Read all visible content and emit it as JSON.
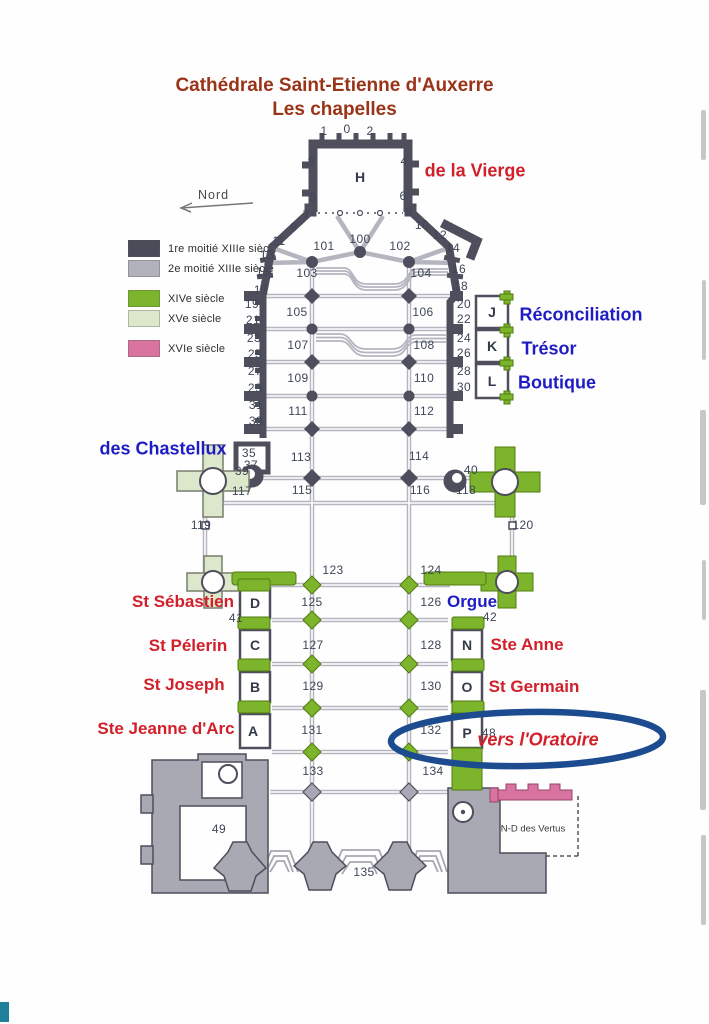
{
  "title": {
    "line1": "Cathédrale Saint-Etienne d'Auxerre",
    "line2": "Les chapelles"
  },
  "north_label": "Nord",
  "colors": {
    "title_red": "#9a3418",
    "chapel_red": "#d2202a",
    "chapel_blue": "#1f1cc4",
    "highlight_ellipse_blue": "#1c4c8f",
    "wall_dark": "#4e4e5c",
    "wall_light": "#b5b5c0",
    "green_14c": "#7cb52b",
    "palegreen_15c": "#dde7cb",
    "pink_16c": "#d9739f"
  },
  "legend": {
    "items": [
      {
        "label": "1re moitié XIIIe siècle",
        "color": "#4b4b59",
        "gap": false
      },
      {
        "label": "2e moitié XIIIe siècle",
        "color": "#b2b2bc",
        "gap": false
      },
      {
        "label": "XIVe siècle",
        "color": "#7cb52b",
        "gap": true
      },
      {
        "label": "XVe siècle",
        "color": "#dde7cb",
        "gap": false
      },
      {
        "label": "XVIe siècle",
        "color": "#d9739f",
        "gap": true
      }
    ]
  },
  "plan": {
    "highlight_label": "vers l'Oratoire",
    "labels": [
      {
        "t": "1",
        "x": 324,
        "y": 131,
        "k": "n"
      },
      {
        "t": "0",
        "x": 347,
        "y": 129,
        "k": "n"
      },
      {
        "t": "2",
        "x": 370,
        "y": 131,
        "k": "n"
      },
      {
        "t": "3",
        "x": 311,
        "y": 162,
        "k": "n"
      },
      {
        "t": "4",
        "x": 404,
        "y": 161,
        "k": "n"
      },
      {
        "t": "5",
        "x": 313,
        "y": 197,
        "k": "n"
      },
      {
        "t": "6",
        "x": 403,
        "y": 196,
        "k": "n"
      },
      {
        "t": "7",
        "x": 306,
        "y": 215,
        "k": "n"
      },
      {
        "t": "8",
        "x": 409,
        "y": 212,
        "k": "n"
      },
      {
        "t": "9",
        "x": 294,
        "y": 227,
        "k": "n"
      },
      {
        "t": "10",
        "x": 422,
        "y": 225,
        "k": "n"
      },
      {
        "t": "11",
        "x": 279,
        "y": 241,
        "k": "n"
      },
      {
        "t": "12",
        "x": 440,
        "y": 235,
        "k": "n"
      },
      {
        "t": "13",
        "x": 267,
        "y": 255,
        "k": "n"
      },
      {
        "t": "14",
        "x": 453,
        "y": 248,
        "k": "n"
      },
      {
        "t": "15",
        "x": 263,
        "y": 272,
        "k": "n"
      },
      {
        "t": "16",
        "x": 459,
        "y": 269,
        "k": "n"
      },
      {
        "t": "17",
        "x": 261,
        "y": 290,
        "k": "n"
      },
      {
        "t": "18",
        "x": 461,
        "y": 286,
        "k": "n"
      },
      {
        "t": "19",
        "x": 252,
        "y": 304,
        "k": "n"
      },
      {
        "t": "20",
        "x": 464,
        "y": 304,
        "k": "n"
      },
      {
        "t": "21",
        "x": 253,
        "y": 320,
        "k": "n"
      },
      {
        "t": "22",
        "x": 464,
        "y": 319,
        "k": "n"
      },
      {
        "t": "23",
        "x": 254,
        "y": 338,
        "k": "n"
      },
      {
        "t": "24",
        "x": 464,
        "y": 338,
        "k": "n"
      },
      {
        "t": "25",
        "x": 255,
        "y": 354,
        "k": "n"
      },
      {
        "t": "26",
        "x": 464,
        "y": 353,
        "k": "n"
      },
      {
        "t": "27",
        "x": 255,
        "y": 371,
        "k": "n"
      },
      {
        "t": "28",
        "x": 464,
        "y": 371,
        "k": "n"
      },
      {
        "t": "29",
        "x": 255,
        "y": 388,
        "k": "n"
      },
      {
        "t": "30",
        "x": 464,
        "y": 387,
        "k": "n"
      },
      {
        "t": "31",
        "x": 256,
        "y": 405,
        "k": "n"
      },
      {
        "t": "33",
        "x": 256,
        "y": 421,
        "k": "n"
      },
      {
        "t": "35",
        "x": 249,
        "y": 453,
        "k": "n"
      },
      {
        "t": "37",
        "x": 251,
        "y": 465,
        "k": "n"
      },
      {
        "t": "39",
        "x": 242,
        "y": 471,
        "k": "n"
      },
      {
        "t": "40",
        "x": 471,
        "y": 470,
        "k": "n"
      },
      {
        "t": "41",
        "x": 236,
        "y": 618,
        "k": "n"
      },
      {
        "t": "42",
        "x": 490,
        "y": 617,
        "k": "n"
      },
      {
        "t": "48",
        "x": 489,
        "y": 733,
        "k": "n"
      },
      {
        "t": "49",
        "x": 219,
        "y": 829,
        "k": "n"
      },
      {
        "t": "100",
        "x": 360,
        "y": 239,
        "k": "n"
      },
      {
        "t": "101",
        "x": 324,
        "y": 246,
        "k": "n"
      },
      {
        "t": "102",
        "x": 400,
        "y": 246,
        "k": "n"
      },
      {
        "t": "103",
        "x": 307,
        "y": 273,
        "k": "n"
      },
      {
        "t": "104",
        "x": 421,
        "y": 273,
        "k": "n"
      },
      {
        "t": "105",
        "x": 297,
        "y": 312,
        "k": "n"
      },
      {
        "t": "106",
        "x": 423,
        "y": 312,
        "k": "n"
      },
      {
        "t": "107",
        "x": 298,
        "y": 345,
        "k": "n"
      },
      {
        "t": "108",
        "x": 424,
        "y": 345,
        "k": "n"
      },
      {
        "t": "109",
        "x": 298,
        "y": 378,
        "k": "n"
      },
      {
        "t": "110",
        "x": 424,
        "y": 378,
        "k": "n"
      },
      {
        "t": "111",
        "x": 298,
        "y": 411,
        "k": "n"
      },
      {
        "t": "112",
        "x": 424,
        "y": 411,
        "k": "n"
      },
      {
        "t": "113",
        "x": 301,
        "y": 457,
        "k": "n"
      },
      {
        "t": "114",
        "x": 419,
        "y": 456,
        "k": "n"
      },
      {
        "t": "115",
        "x": 302,
        "y": 490,
        "k": "n"
      },
      {
        "t": "116",
        "x": 420,
        "y": 490,
        "k": "n"
      },
      {
        "t": "117",
        "x": 242,
        "y": 491,
        "k": "n"
      },
      {
        "t": "118",
        "x": 466,
        "y": 490,
        "k": "n"
      },
      {
        "t": "119",
        "x": 201,
        "y": 525,
        "k": "n"
      },
      {
        "t": "120",
        "x": 523,
        "y": 525,
        "k": "n"
      },
      {
        "t": "123",
        "x": 333,
        "y": 570,
        "k": "n"
      },
      {
        "t": "124",
        "x": 431,
        "y": 570,
        "k": "n"
      },
      {
        "t": "125",
        "x": 312,
        "y": 602,
        "k": "n"
      },
      {
        "t": "126",
        "x": 431,
        "y": 602,
        "k": "n"
      },
      {
        "t": "127",
        "x": 313,
        "y": 645,
        "k": "n"
      },
      {
        "t": "128",
        "x": 431,
        "y": 645,
        "k": "n"
      },
      {
        "t": "129",
        "x": 313,
        "y": 686,
        "k": "n"
      },
      {
        "t": "130",
        "x": 431,
        "y": 686,
        "k": "n"
      },
      {
        "t": "131",
        "x": 312,
        "y": 730,
        "k": "n"
      },
      {
        "t": "132",
        "x": 431,
        "y": 730,
        "k": "n"
      },
      {
        "t": "133",
        "x": 313,
        "y": 771,
        "k": "n"
      },
      {
        "t": "134",
        "x": 433,
        "y": 771,
        "k": "n"
      },
      {
        "t": "135",
        "x": 364,
        "y": 872,
        "k": "n"
      },
      {
        "t": "H",
        "x": 360,
        "y": 177,
        "k": "l",
        "n": "chapel-letter-H"
      },
      {
        "t": "J",
        "x": 492,
        "y": 312,
        "k": "l",
        "n": "chapel-letter-J"
      },
      {
        "t": "K",
        "x": 492,
        "y": 346,
        "k": "l",
        "n": "chapel-letter-K"
      },
      {
        "t": "L",
        "x": 492,
        "y": 381,
        "k": "l",
        "n": "chapel-letter-L"
      },
      {
        "t": "D",
        "x": 255,
        "y": 603,
        "k": "l",
        "n": "chapel-letter-D"
      },
      {
        "t": "C",
        "x": 255,
        "y": 645,
        "k": "l",
        "n": "chapel-letter-C"
      },
      {
        "t": "B",
        "x": 255,
        "y": 687,
        "k": "l",
        "n": "chapel-letter-B"
      },
      {
        "t": "A",
        "x": 253,
        "y": 731,
        "k": "l",
        "n": "chapel-letter-A"
      },
      {
        "t": "N",
        "x": 467,
        "y": 645,
        "k": "l",
        "n": "chapel-letter-N"
      },
      {
        "t": "O",
        "x": 467,
        "y": 687,
        "k": "l",
        "n": "chapel-letter-O"
      },
      {
        "t": "P",
        "x": 467,
        "y": 733,
        "k": "l",
        "n": "chapel-letter-P"
      },
      {
        "t": "de la Vierge",
        "x": 475,
        "y": 171,
        "k": "r",
        "s": 18,
        "n": "chapel-name-de-la-vierge"
      },
      {
        "t": "Réconciliation",
        "x": 581,
        "y": 315,
        "k": "b",
        "s": 18,
        "n": "chapel-name-reconciliation"
      },
      {
        "t": "Trésor",
        "x": 549,
        "y": 349,
        "k": "b",
        "s": 18,
        "n": "chapel-name-tresor"
      },
      {
        "t": "Boutique",
        "x": 557,
        "y": 383,
        "k": "b",
        "s": 18,
        "n": "chapel-name-boutique"
      },
      {
        "t": "des Chastellux",
        "x": 163,
        "y": 449,
        "k": "b",
        "s": 18,
        "n": "chapel-name-des-chastellux"
      },
      {
        "t": "St Sébastien",
        "x": 183,
        "y": 602,
        "k": "r",
        "n": "chapel-name-st-sebastien"
      },
      {
        "t": "Orgue",
        "x": 472,
        "y": 602,
        "k": "b",
        "n": "chapel-name-orgue"
      },
      {
        "t": "St Pélerin",
        "x": 188,
        "y": 646,
        "k": "r",
        "n": "chapel-name-st-pelerin"
      },
      {
        "t": "Ste Anne",
        "x": 527,
        "y": 645,
        "k": "r",
        "n": "chapel-name-ste-anne"
      },
      {
        "t": "St Joseph",
        "x": 184,
        "y": 685,
        "k": "r",
        "n": "chapel-name-st-joseph"
      },
      {
        "t": "St Germain",
        "x": 534,
        "y": 687,
        "k": "r",
        "n": "chapel-name-st-germain"
      },
      {
        "t": "Ste Jeanne d'Arc",
        "x": 166,
        "y": 729,
        "k": "r",
        "n": "chapel-name-ste-jeanne-darc"
      },
      {
        "t": "vers l'Oratoire",
        "x": 538,
        "y": 740,
        "k": "ri",
        "n": "chapel-name-vers-l-oratoire"
      },
      {
        "t": "N-D des Vertus",
        "x": 533,
        "y": 829,
        "k": "t",
        "n": "chapel-name-nd-des-vertus"
      }
    ]
  }
}
